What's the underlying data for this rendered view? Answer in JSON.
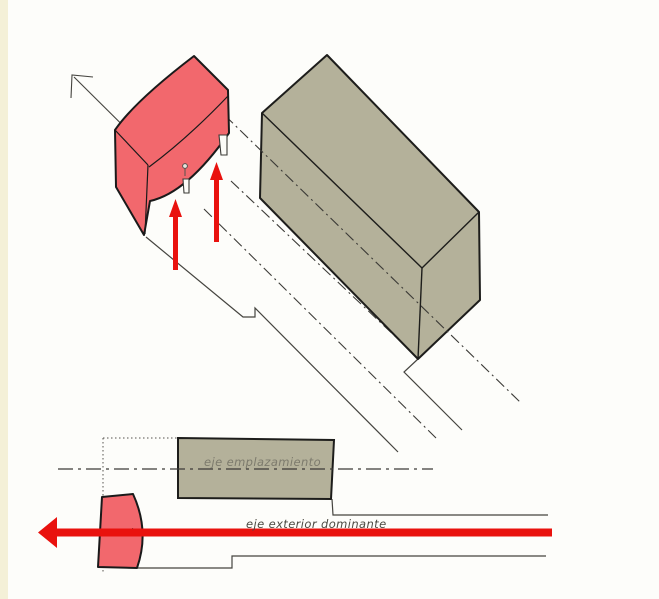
{
  "colors": {
    "paper": "#fdfdfa",
    "edge_strip": "#f2edd0",
    "canopy_red": "#f2686d",
    "arrow_red": "#e9120e",
    "block_olive": "#b4b19a",
    "outline_dark": "#1d1d1b",
    "line_gray": "#45443f",
    "label_light": "#7d7b6d",
    "label_dark": "#4c4a42"
  },
  "labels": {
    "site_axis": "eje emplazamiento",
    "dominant_axis": "eje exterior dominante"
  }
}
